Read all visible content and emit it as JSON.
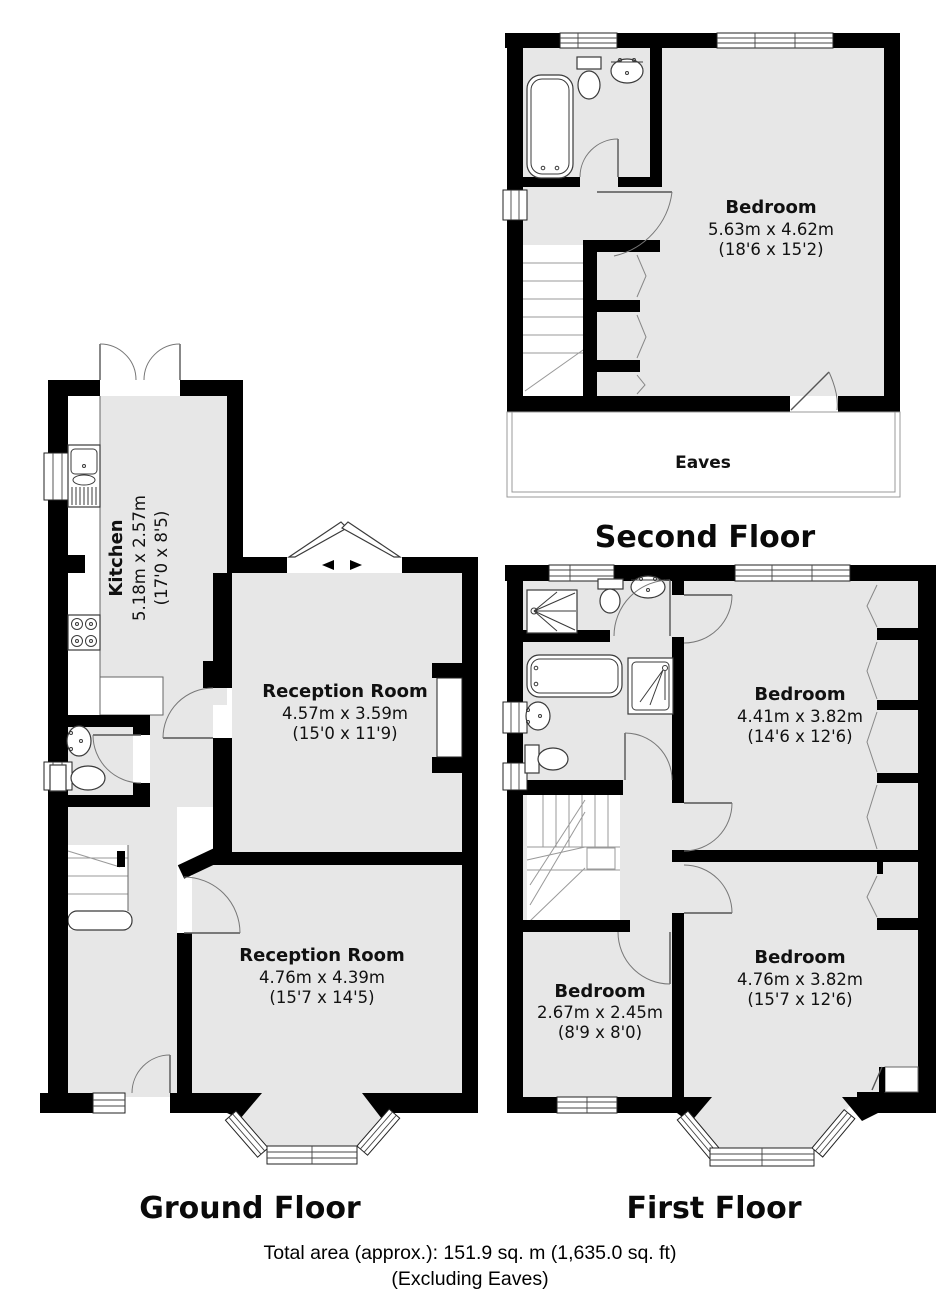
{
  "floors": {
    "second": {
      "title": "Second Floor",
      "eaves_label": "Eaves",
      "bedroom": {
        "name": "Bedroom",
        "metric": "5.63m x 4.62m",
        "imperial": "(18'6 x 15'2)"
      }
    },
    "first": {
      "title": "First Floor",
      "bedroom_front": {
        "name": "Bedroom",
        "metric": "4.41m x 3.82m",
        "imperial": "(14'6 x 12'6)"
      },
      "bedroom_back": {
        "name": "Bedroom",
        "metric": "4.76m x 3.82m",
        "imperial": "(15'7 x 12'6)"
      },
      "bedroom_small": {
        "name": "Bedroom",
        "metric": "2.67m x 2.45m",
        "imperial": "(8'9 x 8'0)"
      }
    },
    "ground": {
      "title": "Ground Floor",
      "kitchen": {
        "name": "Kitchen",
        "metric": "5.18m x 2.57m",
        "imperial": "(17'0 x 8'5)"
      },
      "reception_front": {
        "name": "Reception Room",
        "metric": "4.57m x 3.59m",
        "imperial": "(15'0 x 11'9)"
      },
      "reception_back": {
        "name": "Reception Room",
        "metric": "4.76m x 4.39m",
        "imperial": "(15'7 x 14'5)"
      }
    }
  },
  "footer": {
    "total_area": "Total area (approx.): 151.9 sq. m (1,635.0 sq. ft)",
    "note": "(Excluding Eaves)"
  },
  "colors": {
    "wall": "#000000",
    "room_fill": "#e7e7e7",
    "line": "#666666"
  }
}
